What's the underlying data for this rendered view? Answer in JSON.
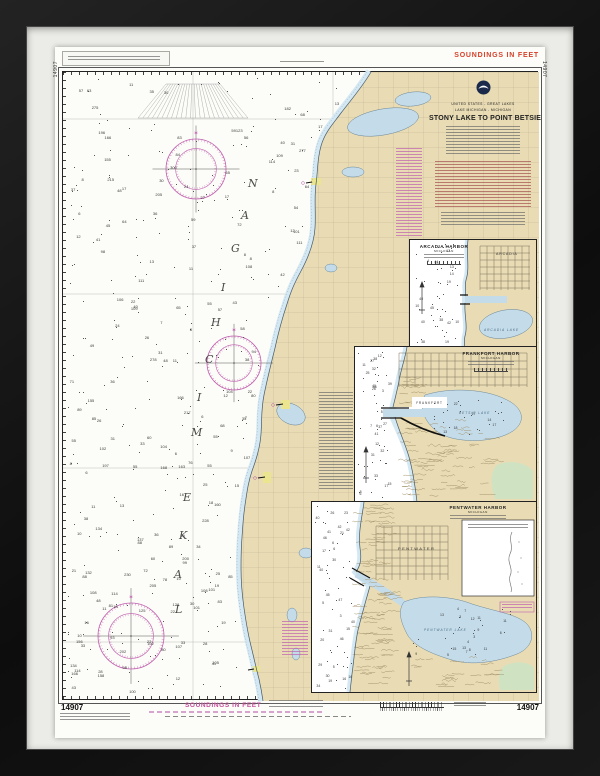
{
  "chart": {
    "number": "14907",
    "top_margin": {
      "soundings_label": "SOUNDINGS IN FEET"
    },
    "bottom_margin": {
      "soundings_label": "SOUNDINGS IN FEET",
      "number_left": "14907",
      "number_right": "14907"
    },
    "side_numbers": {
      "left": "14907",
      "right": "14907"
    },
    "lake_label": "LAKE MICHIGAN",
    "title_block": {
      "country_line": "UNITED STATES - GREAT LAKES",
      "lake_line": "LAKE MICHIGAN - MICHIGAN",
      "title": "STONY LAKE TO POINT BETSIE"
    },
    "insets": [
      {
        "title": "ARCADIA HARBOR",
        "subtitle": "MICHIGAN",
        "town_label": "ARCADIA",
        "water_label": "ARCADIA LAKE"
      },
      {
        "title": "FRANKFORT HARBOR",
        "subtitle": "MICHIGAN",
        "town_label": "FRANKFORT",
        "water_label": "BETSIE LAKE"
      },
      {
        "title": "PENTWATER HARBOR",
        "subtitle": "MICHIGAN",
        "town_label": "PENTWATER",
        "water_label": "PENTWATER LAKE"
      }
    ],
    "colors": {
      "paper": "#fcfcf8",
      "land": "#e9dcb4",
      "water": "#c4dcea",
      "green": "#cfe3c3",
      "magenta": "#c060ae",
      "soundings_red": "#d8402a",
      "soundings_magenta": "#c7519e",
      "mat": "#ebebe7",
      "frame": "#151515"
    }
  }
}
